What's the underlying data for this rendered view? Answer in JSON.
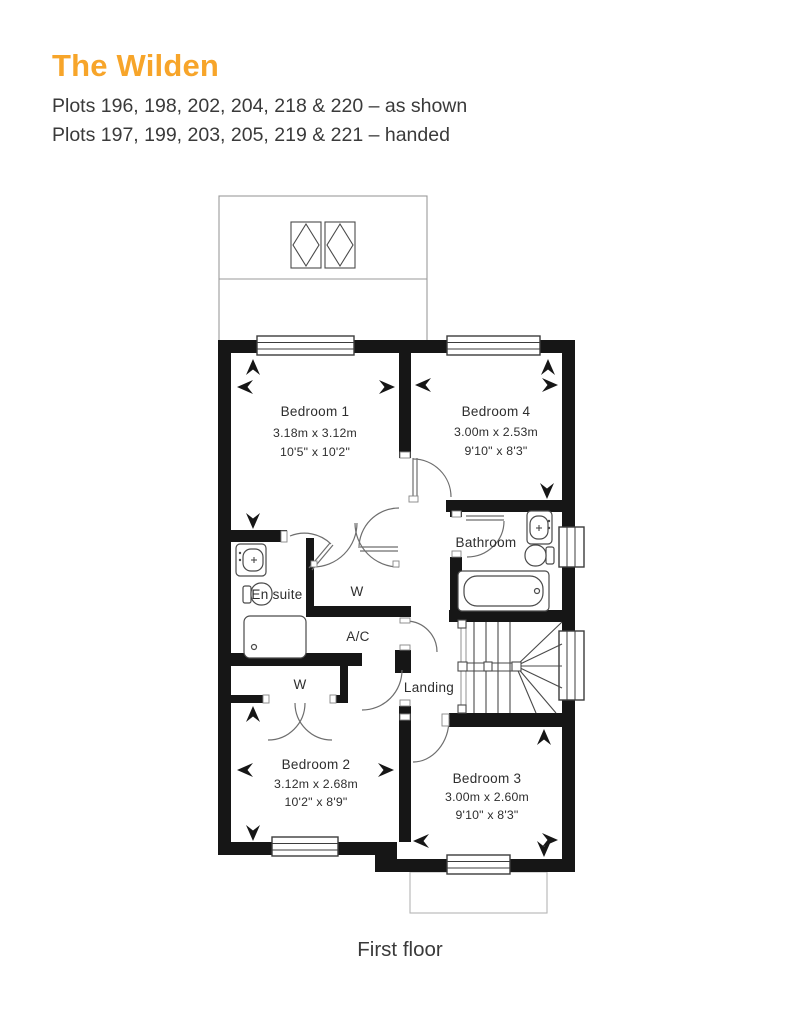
{
  "header": {
    "title": "The Wilden",
    "plots_line1": "Plots 196, 198, 202, 204, 218 & 220 – as shown",
    "plots_line2": "Plots 197, 199, 203, 205, 219 & 221 – handed"
  },
  "floor_caption": "First floor",
  "colors": {
    "accent": "#F7A52A",
    "text": "#3A3A3A",
    "wall": "#161616"
  },
  "rooms": {
    "bedroom1": {
      "name": "Bedroom 1",
      "metric": "3.18m x 3.12m",
      "imperial": "10'5\" x 10'2\""
    },
    "bedroom4": {
      "name": "Bedroom 4",
      "metric": "3.00m x 2.53m",
      "imperial": "9'10\" x 8'3\""
    },
    "bedroom2": {
      "name": "Bedroom 2",
      "metric": "3.12m x 2.68m",
      "imperial": "10'2\" x 8'9\""
    },
    "bedroom3": {
      "name": "Bedroom 3",
      "metric": "3.00m x 2.60m",
      "imperial": "9'10\" x 8'3\""
    },
    "bathroom": {
      "name": "Bathroom"
    },
    "ensuite": {
      "name": "En suite"
    },
    "landing": {
      "name": "Landing"
    },
    "wardrobe_top": {
      "label": "W"
    },
    "wardrobe_bedroom2": {
      "label": "W"
    },
    "airing_cupboard": {
      "label": "A/C"
    }
  }
}
